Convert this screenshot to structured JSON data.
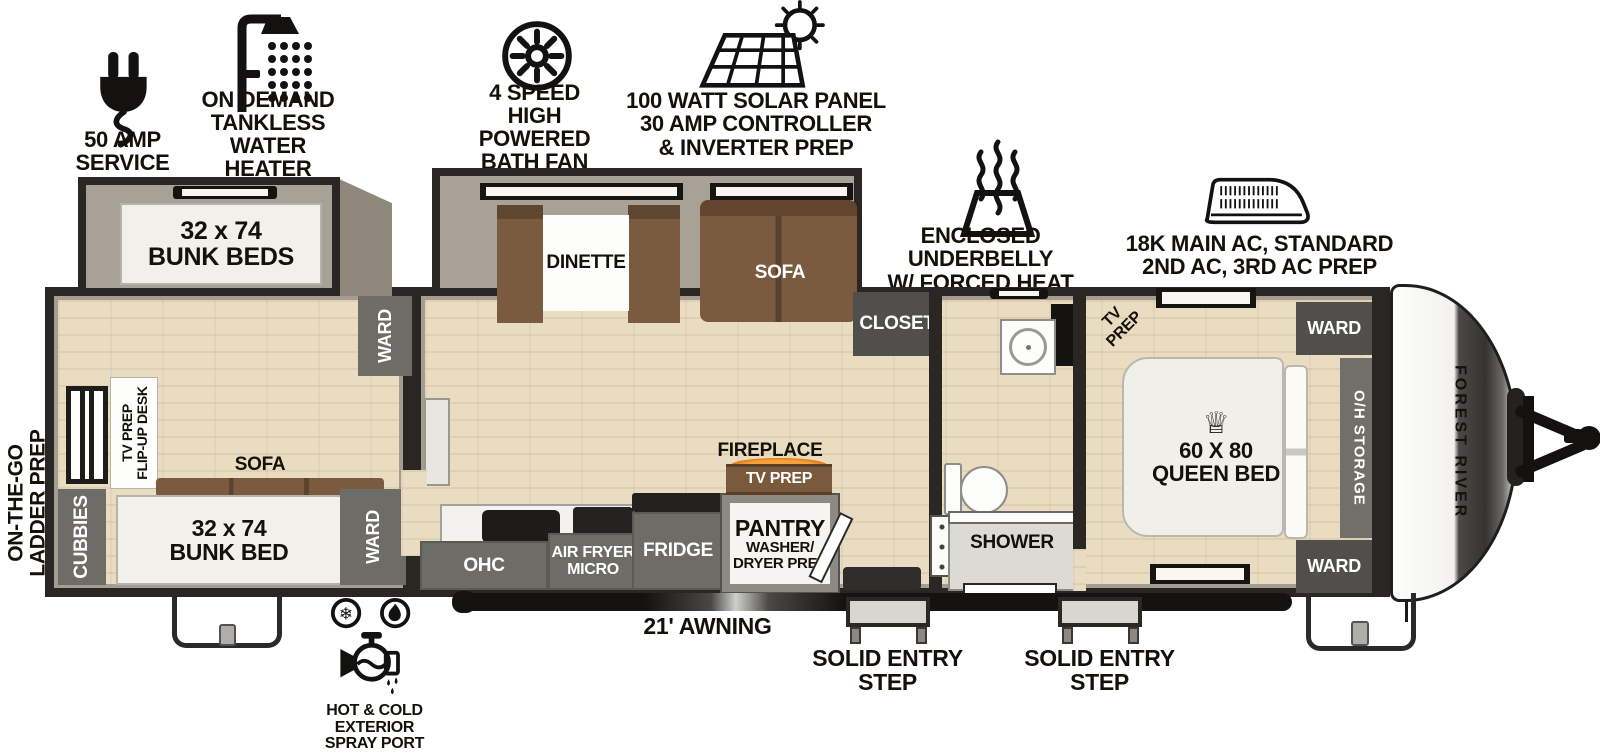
{
  "features": [
    {
      "icon": "power-plug-icon",
      "label": "50 AMP SERVICE"
    },
    {
      "icon": "shower-head-icon",
      "label": "ON DEMAND\nTANKLESS\nWATER HEATER"
    },
    {
      "icon": "roof-fan-icon",
      "label": "4 SPEED\nHIGH POWERED\nBATH FAN"
    },
    {
      "icon": "solar-panel-icon",
      "label": "100 WATT SOLAR PANEL\n30 AMP CONTROLLER\n& INVERTER PREP"
    },
    {
      "icon": "forced-heat-icon",
      "label": "ENCLOSED UNDERBELLY\nW/ FORCED HEAT"
    },
    {
      "icon": "ac-unit-icon",
      "label": "18K MAIN AC, STANDARD\n2ND AC, 3RD AC PREP"
    }
  ],
  "exterior": {
    "ladder_prep": "ON-THE-GO\nLADDER PREP",
    "awning": "21' AWNING",
    "entry_step": "SOLID ENTRY\nSTEP",
    "spray_port": "HOT & COLD EXTERIOR\nSPRAY PORT",
    "brand": "FOREST RIVER"
  },
  "bunk_room": {
    "slide_bunk": "32 x 74\nBUNK BEDS",
    "ward_top": "WARD",
    "desk": "TV PREP\nFLIP-UP DESK",
    "sofa": "SOFA",
    "bunk_bed": "32 x 74\nBUNK BED",
    "cubbies": "CUBBIES",
    "ward_bottom": "WARD"
  },
  "living": {
    "dinette": "DINETTE",
    "sofa": "SOFA",
    "closet": "CLOSET",
    "fireplace": "FIREPLACE",
    "tv_prep": "TV PREP"
  },
  "kitchen": {
    "ohc": "OHC",
    "air_fryer_micro": "AIR FRYER\nMICRO",
    "fridge": "FRIDGE",
    "pantry": "PANTRY",
    "pantry_sub": "WASHER/\nDRYER PREP"
  },
  "bath": {
    "shower": "SHOWER"
  },
  "bedroom": {
    "tv_prep": "TV PREP",
    "bed": "60 X 80\nQUEEN BED",
    "crown_icon": "♕",
    "oh_storage": "O/H STORAGE",
    "ward_front_top": "WARD",
    "ward_front_bottom": "WARD"
  },
  "colors": {
    "wall": "#292623",
    "wall_fill": "#a49e92",
    "floor_wood": "#e9dcc1",
    "furniture_brown": "#7a5b3f",
    "cabinet_gray": "#6e6c67",
    "flame_orange": "#f09b2c"
  }
}
